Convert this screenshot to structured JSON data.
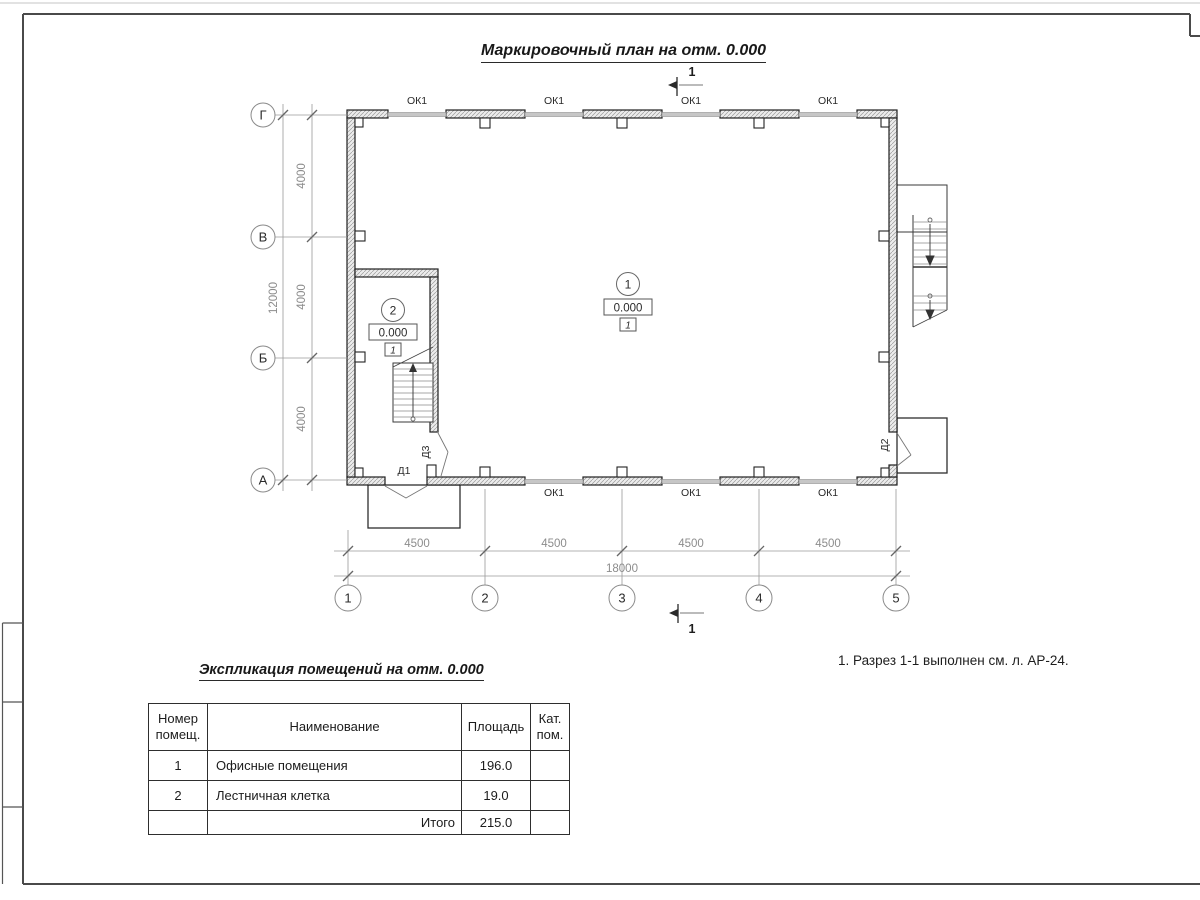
{
  "sheet": {
    "plan_title": "Маркировочный план на отм. 0.000",
    "note": "1. Разрез 1-1 выполнен см. л. АР-24."
  },
  "plan": {
    "window_label": "ОК1",
    "section_label": "1",
    "doors": {
      "d1": "Д1",
      "d2": "Д2",
      "d3": "Д3"
    },
    "rooms": {
      "office": {
        "number": "1",
        "elevation": "0.000",
        "finish_mark": "1"
      },
      "stair": {
        "number": "2",
        "elevation": "0.000",
        "finish_mark": "1"
      }
    },
    "axes": {
      "cols": [
        "1",
        "2",
        "3",
        "4",
        "5"
      ],
      "rows": [
        "Г",
        "В",
        "Б",
        "А"
      ]
    },
    "dims": {
      "col_segments": [
        "4500",
        "4500",
        "4500",
        "4500"
      ],
      "col_total": "18000",
      "row_segments": [
        "4000",
        "4000",
        "4000"
      ],
      "row_total": "12000"
    }
  },
  "schedule": {
    "title": "Экспликация помещений на отм. 0.000",
    "columns": {
      "number": "Номер помещ.",
      "name": "Наименование",
      "area": "Площадь",
      "category": "Кат. пом."
    },
    "rows": [
      {
        "number": "1",
        "name": "Офисные помещения",
        "area": "196.0",
        "category": ""
      },
      {
        "number": "2",
        "name": "Лестничная клетка",
        "area": "19.0",
        "category": ""
      }
    ],
    "total": {
      "label": "Итого",
      "area": "215.0"
    }
  }
}
